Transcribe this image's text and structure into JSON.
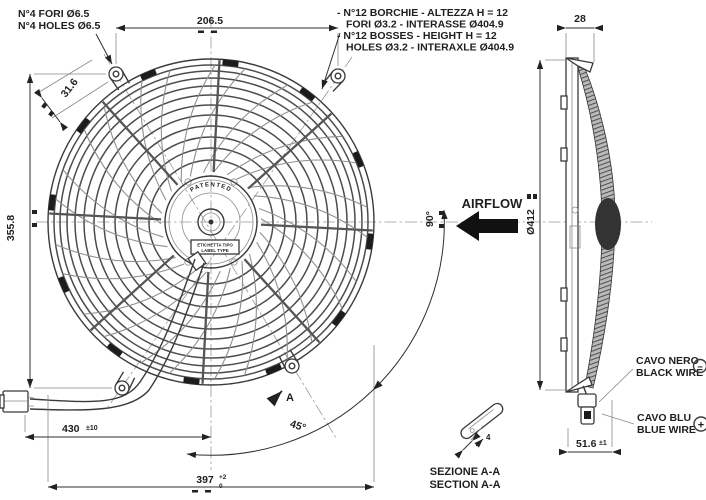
{
  "drawing": {
    "notes": {
      "holes_line1": "N°4 FORI Ø6.5",
      "holes_line2": "N°4 HOLES Ø6.5",
      "bosses_line1": "- N°12 BORCHIE - ALTEZZA H = 12",
      "bosses_line2": "FORI Ø3.2 - INTERASSE Ø404.9",
      "bosses_line3": "- N°12 BOSSES - HEIGHT H = 12",
      "bosses_line4": "HOLES Ø3.2 - INTERAXLE Ø404.9"
    },
    "dims": {
      "top_width": "206.5",
      "depth": "28",
      "hole_offset": "31.6",
      "mount_height": "355.8",
      "diameter": "Ø412",
      "angle_full": "90°",
      "angle_half": "45°",
      "wire_length": "430",
      "wire_length_tol": "±10",
      "overall": "397",
      "overall_tol_plus": "+2",
      "overall_tol_minus": "0",
      "total_depth": "51.6",
      "total_depth_tol": "±1",
      "clip_size": "4"
    },
    "labels": {
      "airflow": "AIRFLOW",
      "patented": "PATENTED",
      "hub_label_line1": "ETICHETTA TIPO",
      "hub_label_line2": "LABEL TYPE",
      "brand": "SPAL",
      "section_marker": "A",
      "section_line1": "SEZIONE A-A",
      "section_line2": "SECTION A-A",
      "black_wire_line1": "CAVO NERO",
      "black_wire_line2": "BLACK WIRE",
      "black_wire_polarity": "−",
      "blue_wire_line1": "CAVO BLU",
      "blue_wire_line2": "BLUE WIRE",
      "blue_wire_polarity": "+"
    },
    "colors": {
      "line": "#3a3a3a",
      "text": "#1f1f1f",
      "background": "#ffffff",
      "dark_fill": "#1c1c1c"
    }
  }
}
